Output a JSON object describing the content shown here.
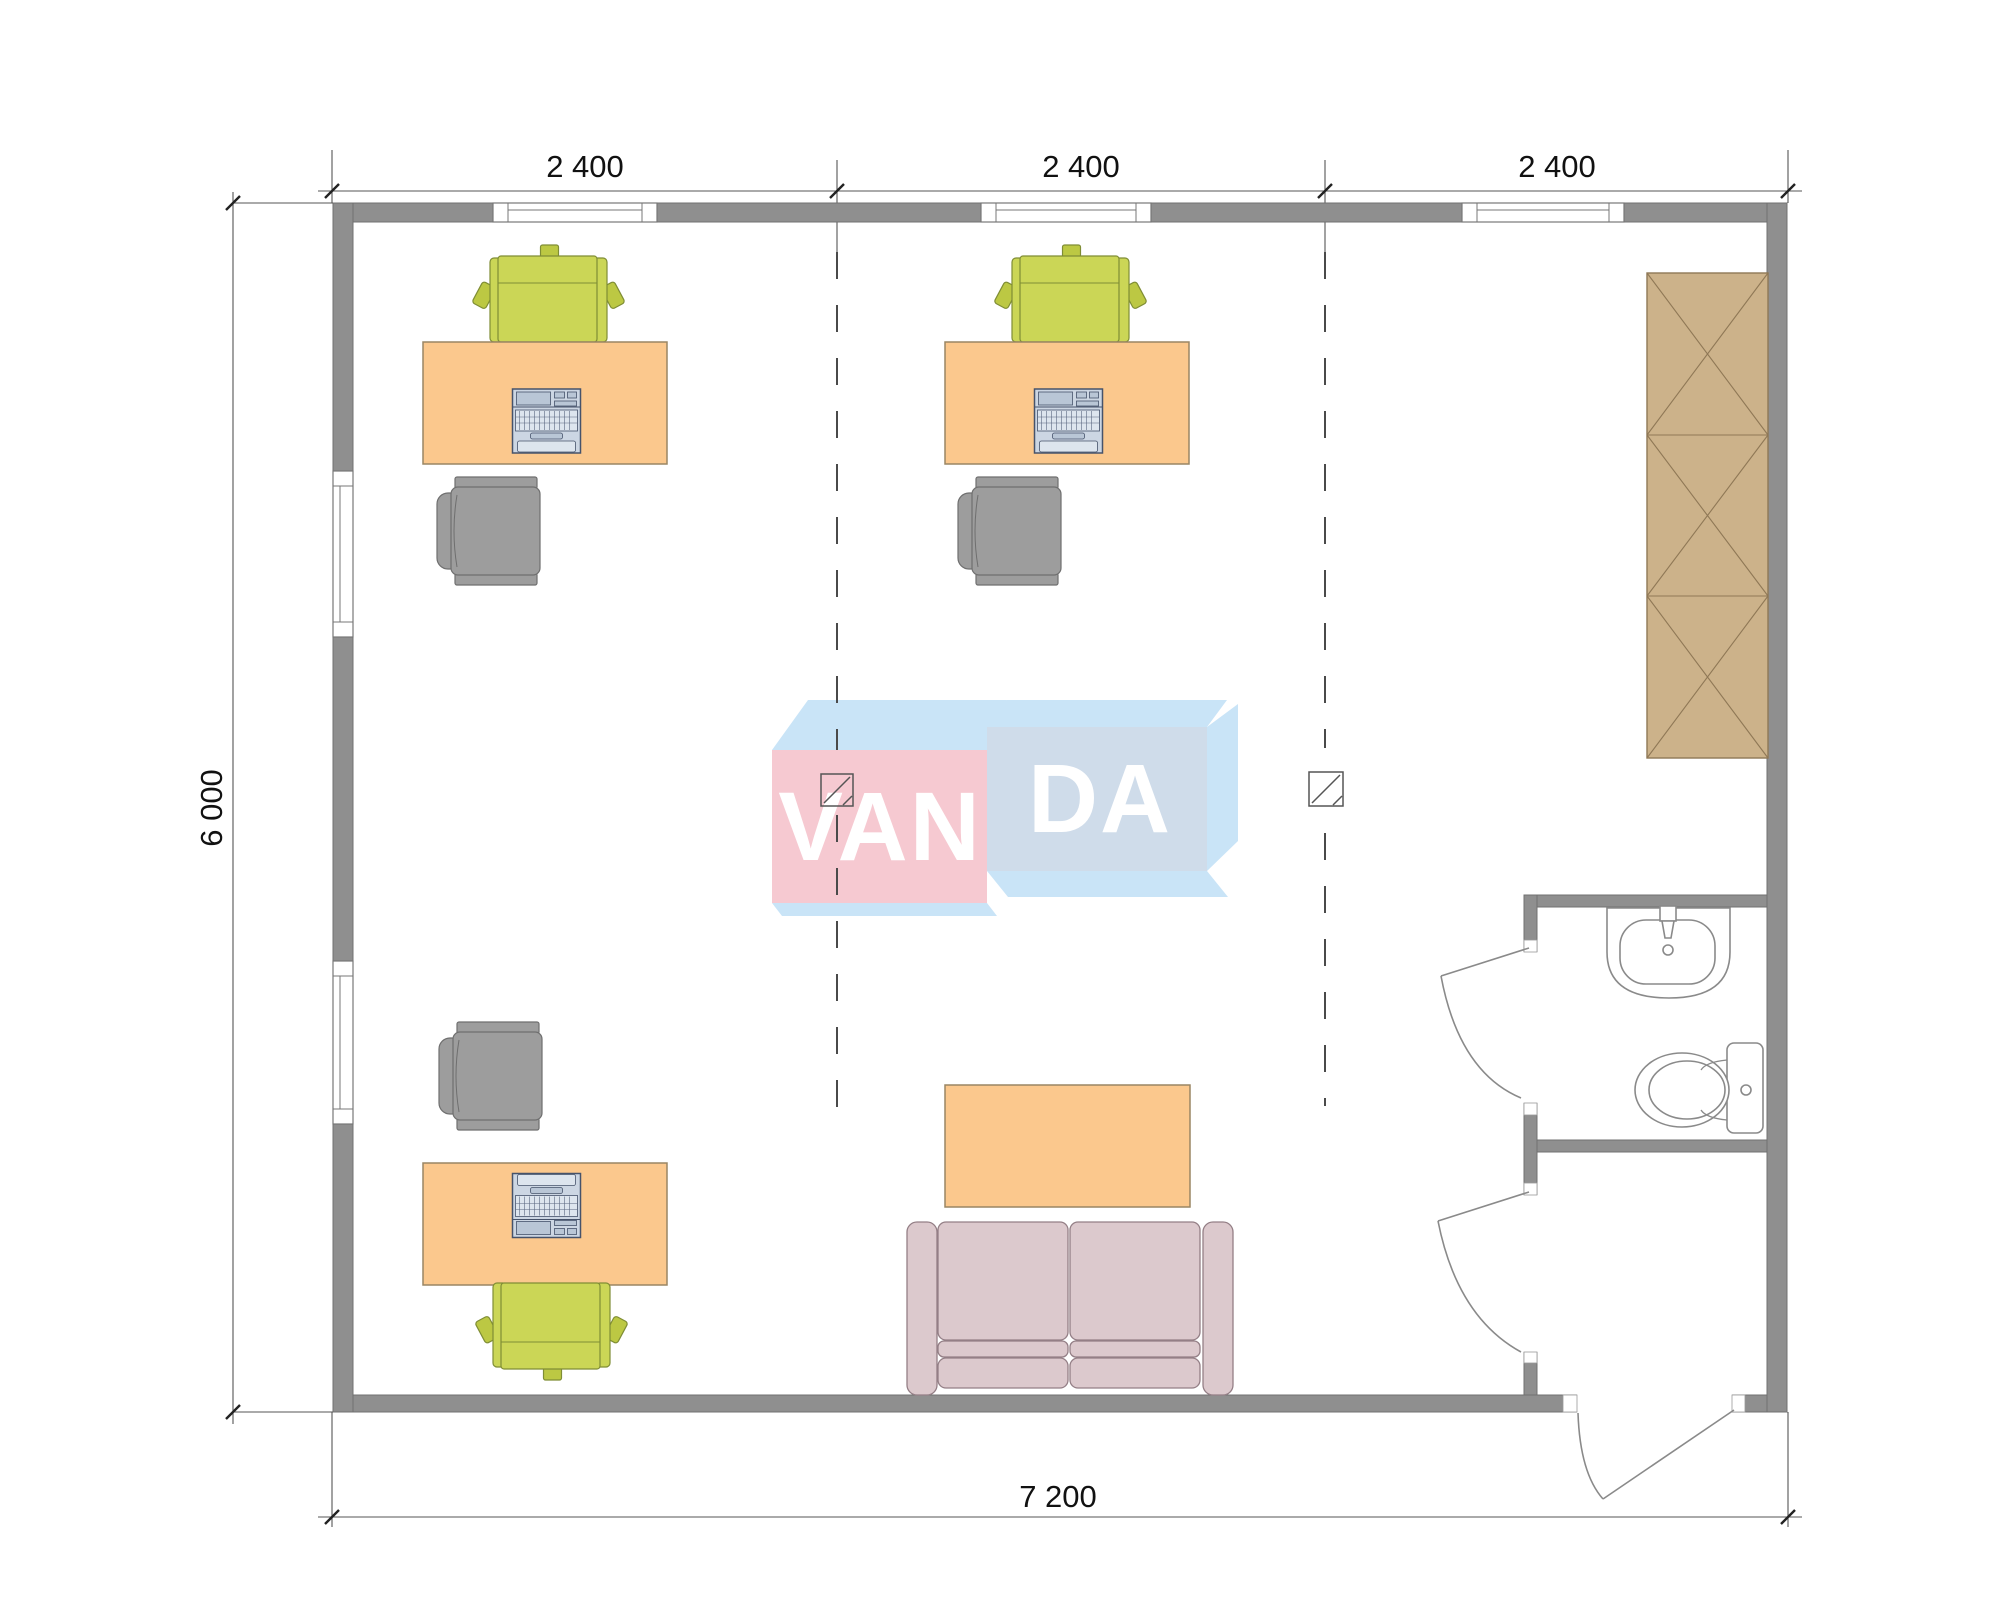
{
  "dimensions": {
    "top": [
      "2 400",
      "2 400",
      "2 400"
    ],
    "left": "6 000",
    "bottom": "7 200"
  },
  "watermark": {
    "brand": "VANDA",
    "left_text": "VAN",
    "right_text": "DA"
  },
  "colors": {
    "wall-fill": "#8f8f8f",
    "wall-line": "#707070",
    "desk-fill": "#fbc88d",
    "desk-line": "#9a8664",
    "chair-green": "#cbd656",
    "chair-green-dark": "#bcc843",
    "chair-green-line": "#7f8d35",
    "chair-gray": "#9d9d9d",
    "chair-gray-line": "#6f6f6f",
    "laptop-fill": "#ccd6e3",
    "laptop-mid": "#b9c6d6",
    "laptop-line": "#46536b",
    "wardrobe-fill": "#ccb28a",
    "wardrobe-line": "#8f7856",
    "sofa-fill": "#dcc9cd",
    "sofa-line": "#947f86",
    "fixture-line": "#8a8a8a",
    "dash-line": "#4a4a4a",
    "dim-line": "#555555",
    "dim-text": "#111111",
    "logo-pink": "#f6c9d1",
    "logo-blue": "#cfdcea",
    "logo-light": "#c9e4f7",
    "logo-text": "#ffffff"
  }
}
